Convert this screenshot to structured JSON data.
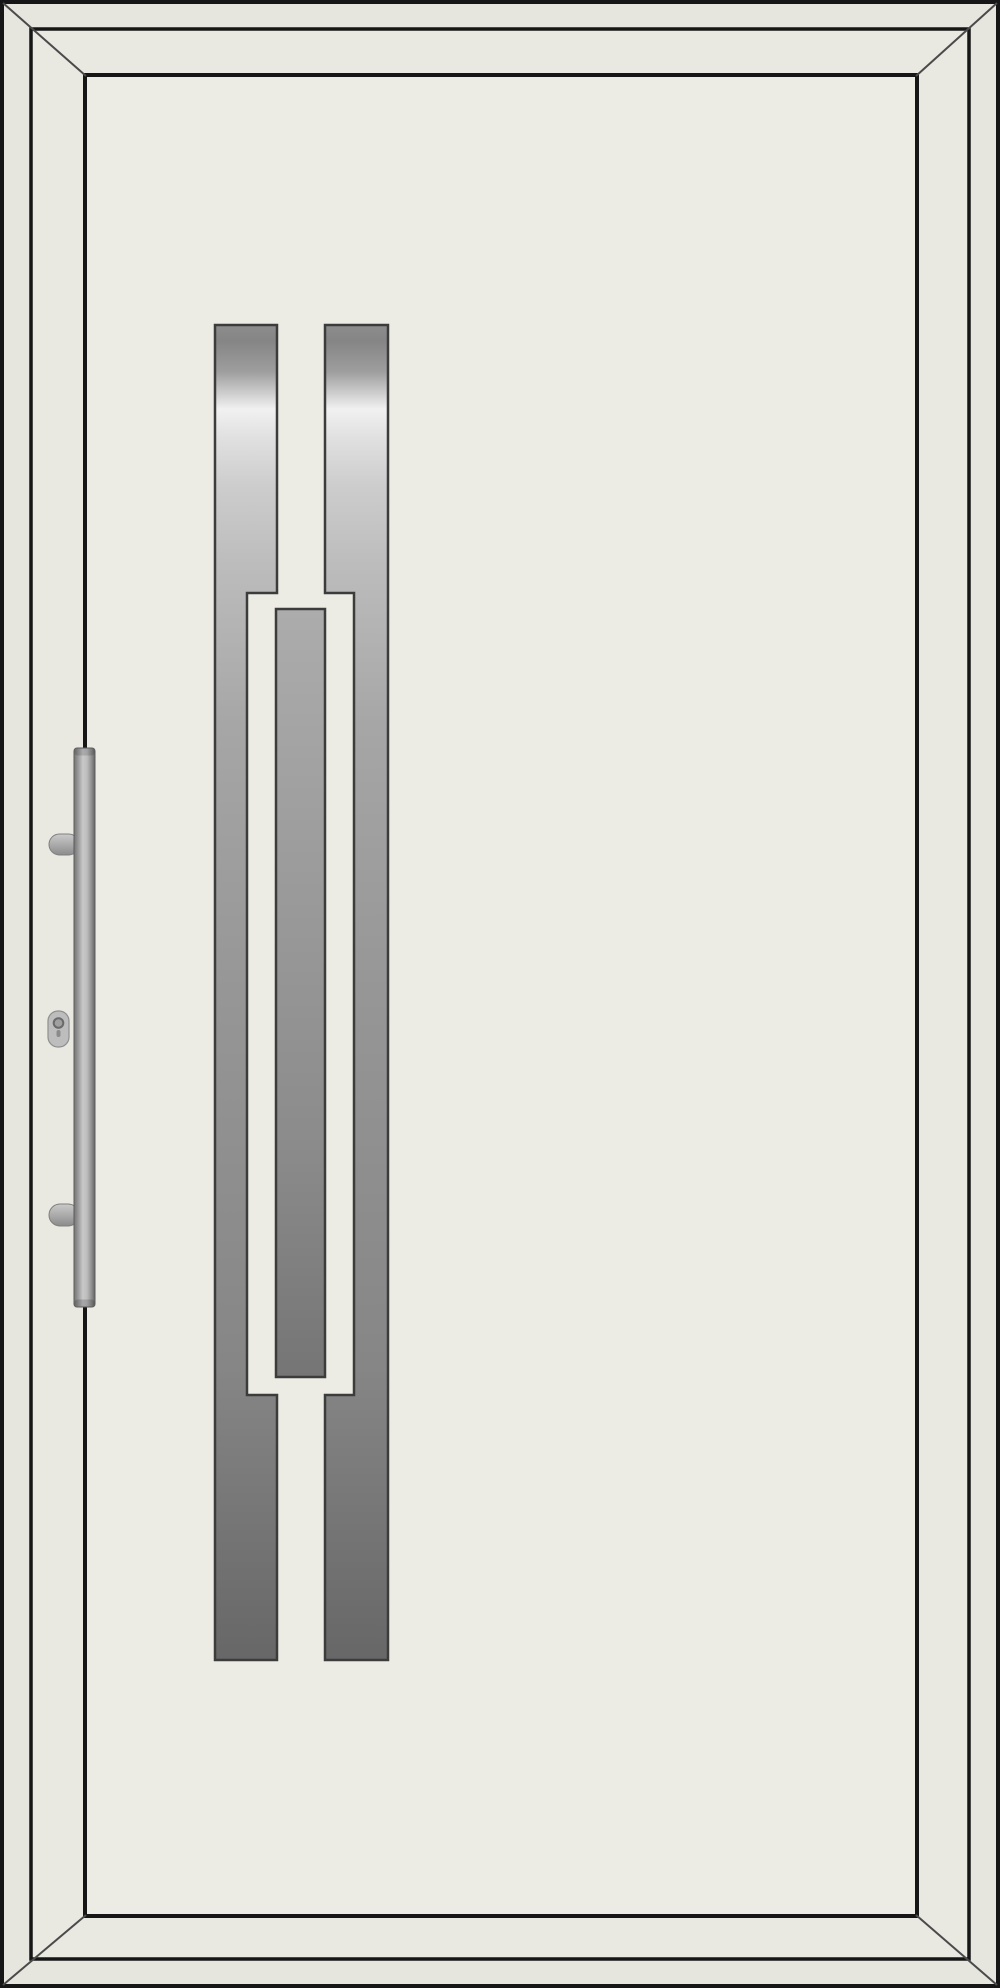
{
  "image": {
    "subject": "entry-door-product-view",
    "orientation": "left-hinged-handle-left"
  },
  "colors": {
    "background": "#ffffff",
    "line_dark": "#161616",
    "miter_line": "#4a4a4a",
    "frame_fill": "#e6e5de",
    "leaf_fill": "#e9e8e1",
    "panel_fill": "#edece4",
    "inlay_outline": "#3c3c3c",
    "steel_top": "#8d8d8d",
    "steel_highlight": "#f1f1f1",
    "steel_mid": "#969696",
    "steel_bottom": "#676767",
    "center_bar_top": "#acacac",
    "center_bar_bottom": "#757575",
    "handle_light": "#c8c8c8",
    "handle_dark": "#646464",
    "pin_light": "#cacaca",
    "pin_dark": "#8b8b8b",
    "cylinder_fill": "#bdbdbd",
    "keyhole_ring": "#6a6a6a"
  },
  "parts": {
    "outer_frame": "door-frame",
    "door_leaf": "door-leaf",
    "door_panel": "door-panel",
    "left_inlay": "stainless-inlay-left",
    "right_inlay": "stainless-inlay-right",
    "center_inlay": "stainless-inlay-center",
    "handle": "pull-bar-handle",
    "handle_mounts": "handle-standoff-pins",
    "lock": "key-cylinder"
  }
}
